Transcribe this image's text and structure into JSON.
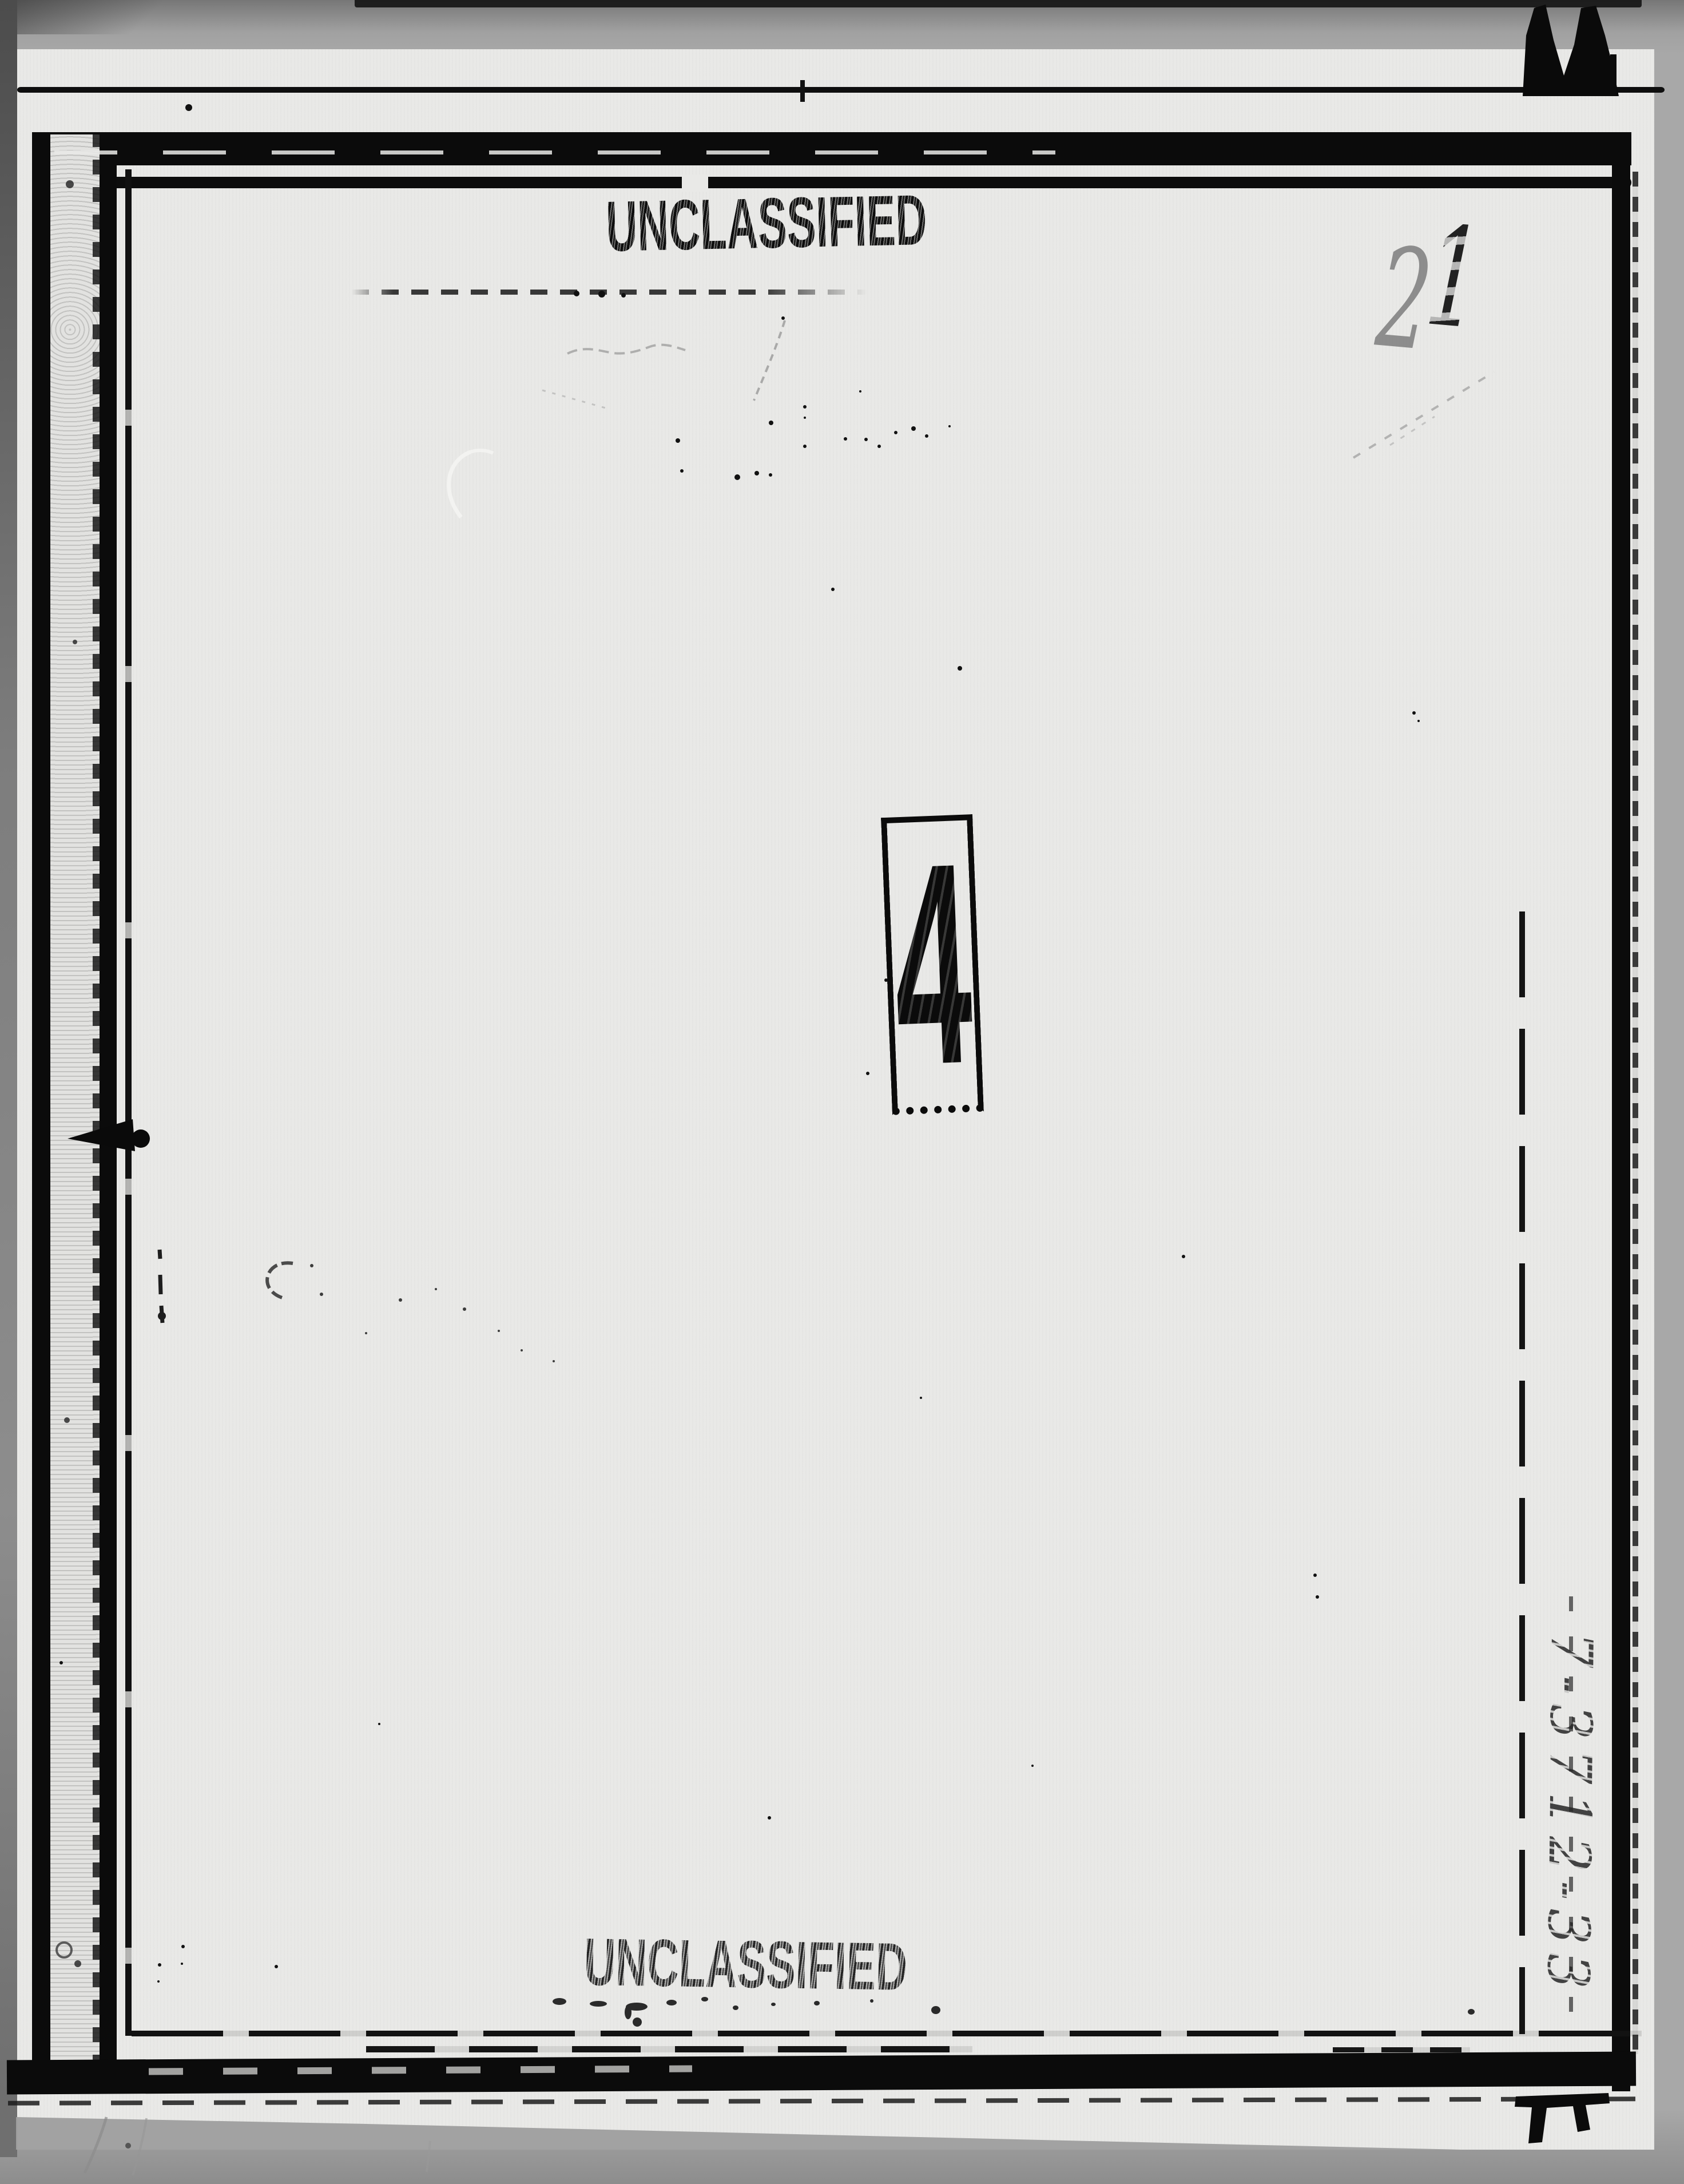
{
  "document": {
    "stamp_top": "UNCLASSIFIED",
    "stamp_bottom": "UNCLASSIFIED",
    "tab_number": "4",
    "page_number": "21",
    "page_number_digits": [
      "2",
      "1"
    ],
    "reference_number": "7-3712-33"
  },
  "colors": {
    "paper": "#e9e9e7",
    "scanner_background": "#a8a8a8",
    "ink": "#0b0b0b",
    "pencil": "#8f8f8f"
  }
}
